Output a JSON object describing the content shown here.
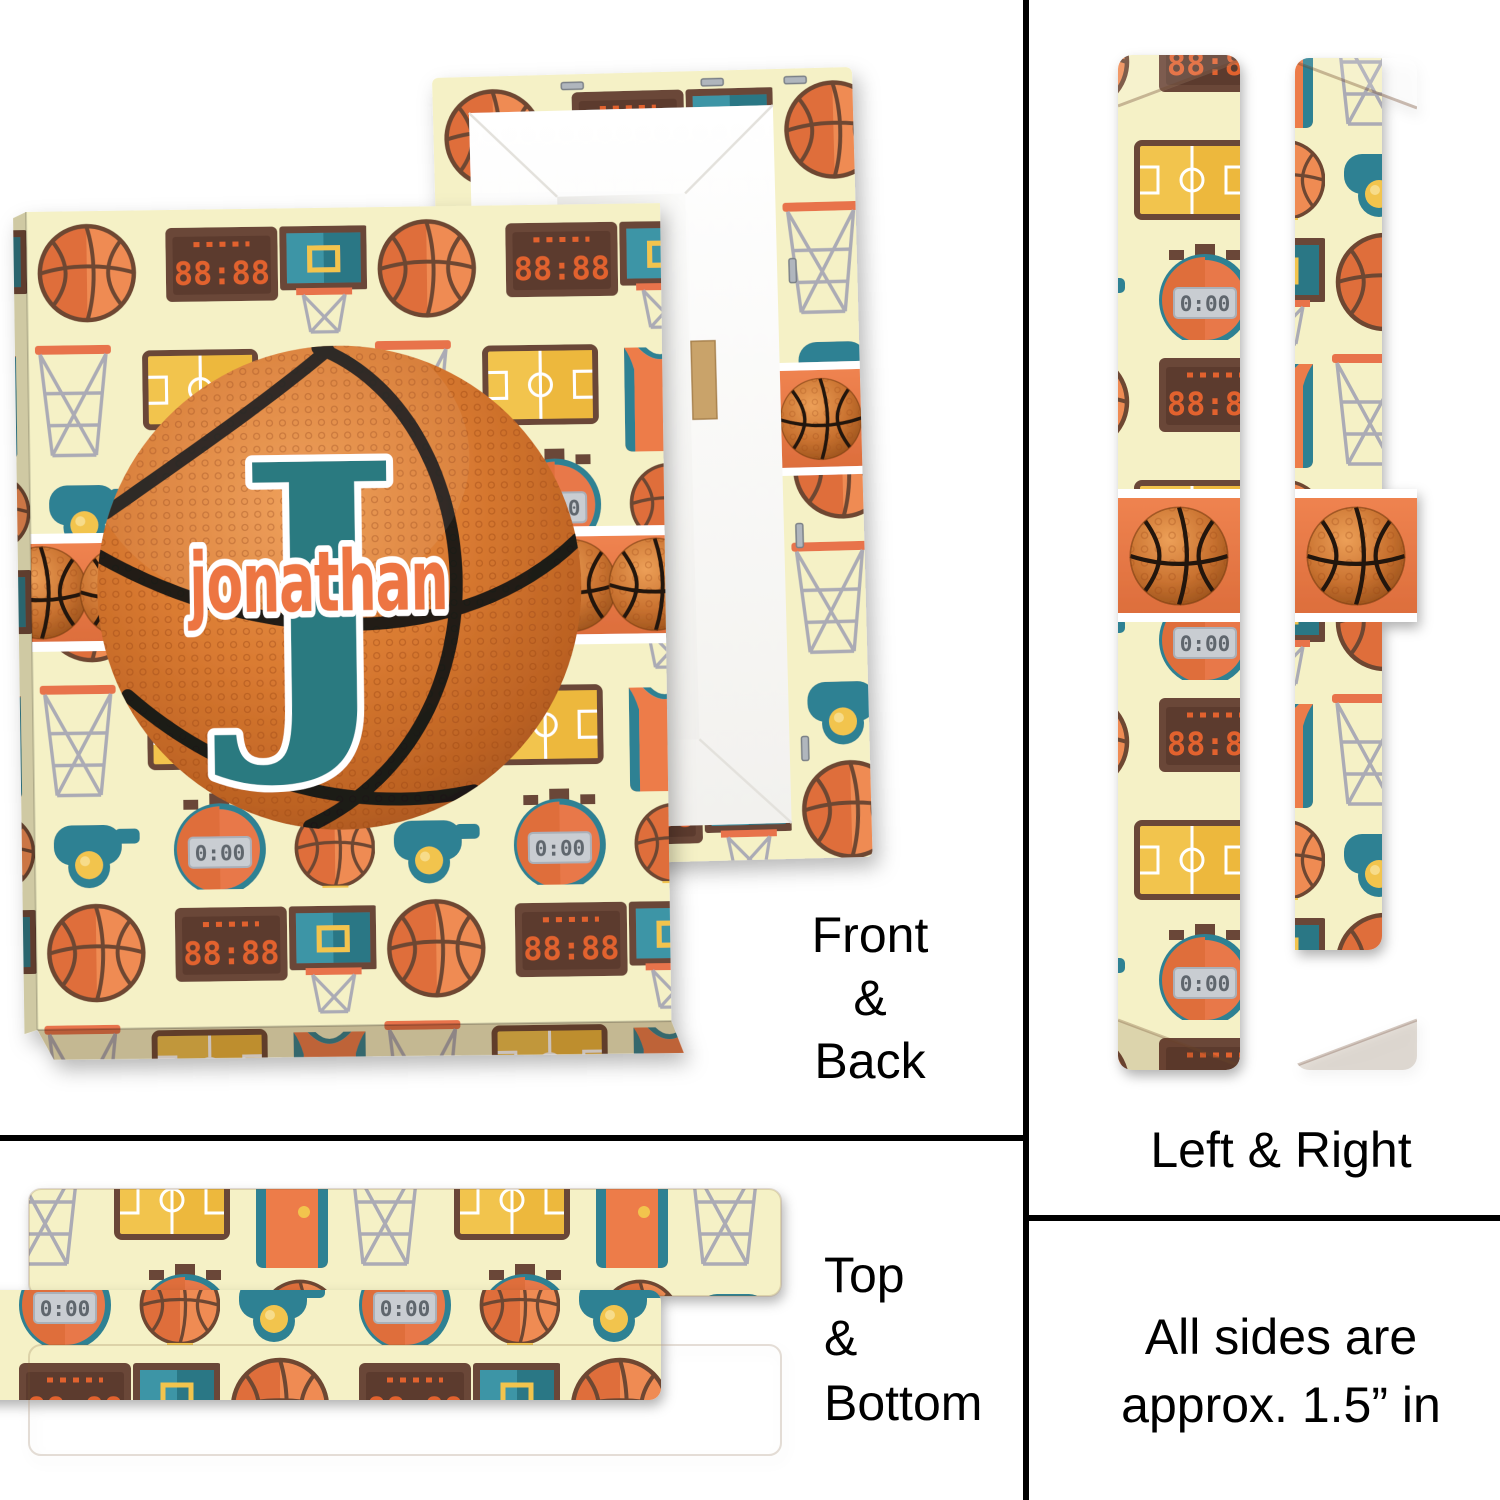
{
  "title": "Personalized basketball canvas print mockup",
  "personalization": {
    "name": "jonathan",
    "initial": "J"
  },
  "labels": {
    "front_back": [
      "Front",
      "&",
      "Back"
    ],
    "left_right": "Left & Right",
    "top_bottom": [
      "Top",
      "&",
      "Bottom"
    ],
    "size_note": [
      "All sides are",
      "approx. 1.5” in"
    ]
  },
  "pattern": {
    "scoreboard_time": "88:88",
    "stopwatch_time": "0:00",
    "icons": [
      "basketball",
      "scoreboard",
      "backboard-hoop",
      "hoop-net",
      "basketball-court",
      "jersey",
      "whistle",
      "stopwatch",
      "basketball-trophy"
    ]
  },
  "colors": {
    "page_background": "#FFFFFF",
    "pattern_cream": "#F5F1C6",
    "orange": "#E8784A",
    "teal": "#2E8193",
    "monogram_teal": "#2B7A80",
    "yellow": "#F2C44E",
    "brown": "#6B4638",
    "net_gray": "#ABABB5",
    "digital_orange": "#E2622F",
    "name_orange": "#ED7443",
    "divider_black": "#000000"
  }
}
